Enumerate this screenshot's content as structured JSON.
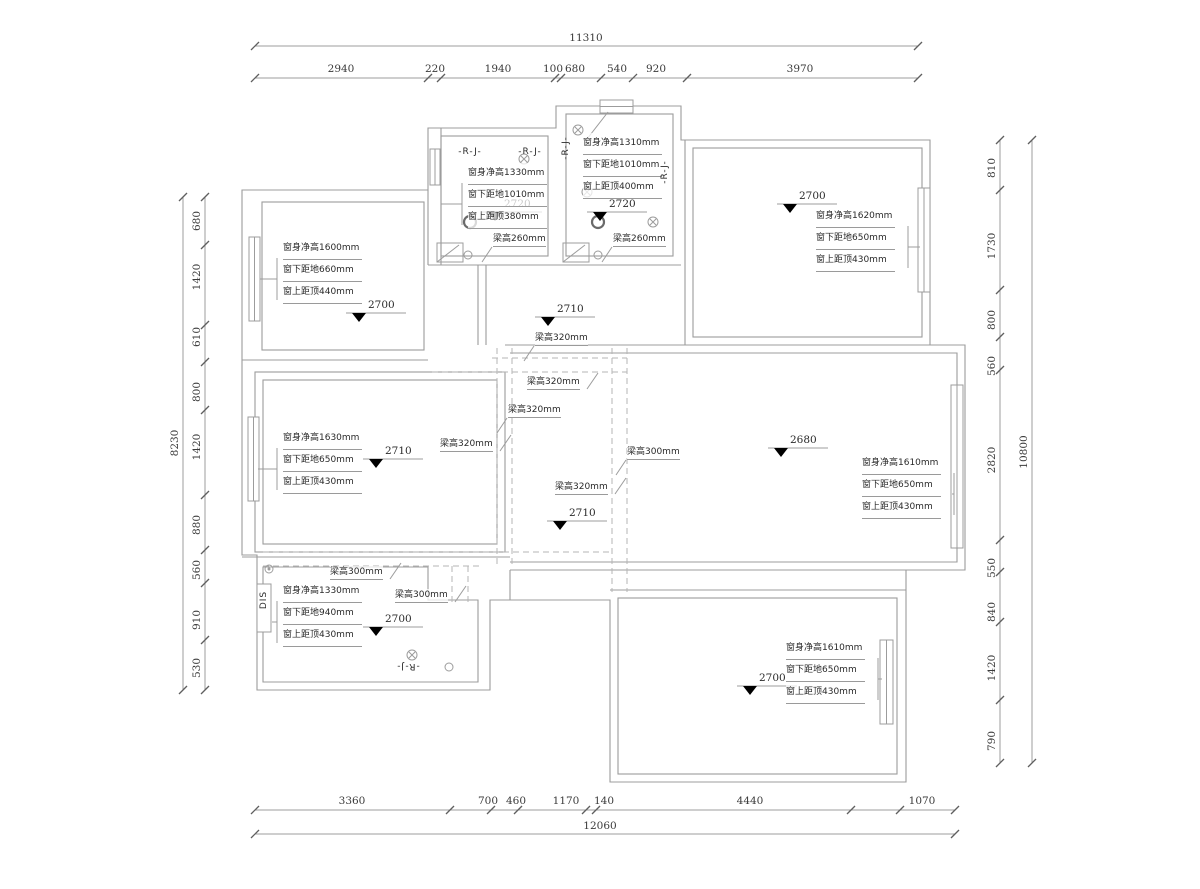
{
  "drawing": {
    "type": "floor-plan construction drawing"
  },
  "colors": {
    "wall_line": "#9c9c9c",
    "dash_line": "#b5b5b5",
    "tick": "#5f5f5f",
    "text": "#2a2a2a",
    "level_marker": "#000000"
  },
  "dim_top": {
    "total": {
      "label": "11310",
      "y": 46,
      "x1": 255,
      "x2": 918,
      "cx": 586
    },
    "seg": {
      "y": 78,
      "x1": 255,
      "x2": 918,
      "ticks": [
        255,
        428,
        441,
        555,
        561,
        601,
        633,
        687,
        918
      ],
      "labels": [
        {
          "t": "2940",
          "cx": 341
        },
        {
          "t": "220",
          "cx": 435
        },
        {
          "t": "1940",
          "cx": 498
        },
        {
          "t": "100",
          "cx": 553
        },
        {
          "t": "680",
          "cx": 575
        },
        {
          "t": "540",
          "cx": 617
        },
        {
          "t": "920",
          "cx": 656
        },
        {
          "t": "3970",
          "cx": 800
        }
      ]
    }
  },
  "dim_bottom": {
    "seg": {
      "y": 810,
      "x1": 255,
      "x2": 955,
      "ticks": [
        255,
        450,
        491,
        518,
        586,
        596,
        851,
        900,
        955
      ],
      "labels": [
        {
          "t": "3360",
          "cx": 352
        },
        {
          "t": "700",
          "cx": 488
        },
        {
          "t": "460",
          "cx": 516
        },
        {
          "t": "1170",
          "cx": 566
        },
        {
          "t": "140",
          "cx": 604
        },
        {
          "t": "4440",
          "cx": 750
        },
        {
          "t": "1070",
          "cx": 922
        }
      ]
    },
    "total": {
      "label": "12060",
      "y": 834,
      "x1": 255,
      "x2": 955,
      "cx": 600
    }
  },
  "dim_left": {
    "seg": {
      "x": 205,
      "y1": 197,
      "y2": 690,
      "ticks": [
        197,
        245,
        325,
        362,
        410,
        495,
        550,
        583,
        640,
        690
      ],
      "labels": [
        {
          "t": "680",
          "cy": 221
        },
        {
          "t": "1420",
          "cy": 277
        },
        {
          "t": "610",
          "cy": 337
        },
        {
          "t": "800",
          "cy": 392
        },
        {
          "t": "1420",
          "cy": 447
        },
        {
          "t": "880",
          "cy": 525
        },
        {
          "t": "560",
          "cy": 570
        },
        {
          "t": "910",
          "cy": 620
        },
        {
          "t": "530",
          "cy": 668
        }
      ]
    },
    "total": {
      "label": "8230",
      "x": 183,
      "y1": 197,
      "y2": 690,
      "cy": 443
    }
  },
  "dim_right": {
    "seg": {
      "x": 1000,
      "y1": 140,
      "y2": 763,
      "ticks": [
        140,
        190,
        290,
        337,
        370,
        540,
        572,
        622,
        700,
        763
      ],
      "labels": [
        {
          "t": "810",
          "cy": 168
        },
        {
          "t": "1730",
          "cy": 246
        },
        {
          "t": "800",
          "cy": 320
        },
        {
          "t": "560",
          "cy": 366
        },
        {
          "t": "2820",
          "cy": 460
        },
        {
          "t": "550",
          "cy": 568
        },
        {
          "t": "840",
          "cy": 612
        },
        {
          "t": "1420",
          "cy": 668
        },
        {
          "t": "790",
          "cy": 741
        }
      ]
    },
    "total": {
      "label": "10800",
      "x": 1032,
      "y1": 140,
      "y2": 763,
      "cy": 452
    }
  },
  "levels": [
    {
      "v": "2700",
      "x": 352,
      "y": 313
    },
    {
      "v": "2720",
      "x": 488,
      "y": 212
    },
    {
      "v": "2720",
      "x": 593,
      "y": 212
    },
    {
      "v": "2700",
      "x": 783,
      "y": 204
    },
    {
      "v": "2710",
      "x": 541,
      "y": 317
    },
    {
      "v": "2710",
      "x": 369,
      "y": 459
    },
    {
      "v": "2710",
      "x": 553,
      "y": 521
    },
    {
      "v": "2680",
      "x": 774,
      "y": 448
    },
    {
      "v": "2700",
      "x": 369,
      "y": 627
    },
    {
      "v": "2700",
      "x": 743,
      "y": 686
    }
  ],
  "window_blocks": [
    {
      "x": 283,
      "y": 238,
      "side": "left",
      "tx": 260,
      "lines": [
        "窗身净高1600mm",
        "窗下距地660mm",
        "窗上距顶440mm"
      ]
    },
    {
      "x": 468,
      "y": 163,
      "side": "left",
      "tx": 441,
      "lines": [
        "窗身净高1330mm",
        "窗下距地1010mm",
        "窗上距顶380mm"
      ]
    },
    {
      "x": 583,
      "y": 133,
      "side": "up",
      "tx": 608,
      "ty": 112,
      "lines": [
        "窗身净高1310mm",
        "窗下距地1010mm",
        "窗上距顶400mm"
      ]
    },
    {
      "x": 816,
      "y": 206,
      "side": "right",
      "tx": 920,
      "lines": [
        "窗身净高1620mm",
        "窗下距地650mm",
        "窗上距顶430mm"
      ]
    },
    {
      "x": 283,
      "y": 428,
      "side": "left",
      "tx": 258,
      "lines": [
        "窗身净高1630mm",
        "窗下距地650mm",
        "窗上距顶430mm"
      ]
    },
    {
      "x": 862,
      "y": 453,
      "side": "right",
      "tx": 952,
      "lines": [
        "窗身净高1610mm",
        "窗下距地650mm",
        "窗上距顶430mm"
      ]
    },
    {
      "x": 283,
      "y": 581,
      "side": "left",
      "tx": 272,
      "lines": [
        "窗身净高1330mm",
        "窗下距地940mm",
        "窗上距顶430mm"
      ]
    },
    {
      "x": 786,
      "y": 638,
      "side": "right",
      "tx": 882,
      "lines": [
        "窗身净高1610mm",
        "窗下距地650mm",
        "窗上距顶430mm"
      ]
    }
  ],
  "beam_labels": [
    {
      "t": "梁高260mm",
      "x": 493,
      "y": 233,
      "dir": "dl"
    },
    {
      "t": "梁高260mm",
      "x": 613,
      "y": 233,
      "dir": "dl"
    },
    {
      "t": "梁高320mm",
      "x": 535,
      "y": 332,
      "dir": "dl"
    },
    {
      "t": "梁高320mm",
      "x": 527,
      "y": 376,
      "dir": "ur"
    },
    {
      "t": "梁高320mm",
      "x": 508,
      "y": 404,
      "dir": "dl"
    },
    {
      "t": "梁高320mm",
      "x": 440,
      "y": 438,
      "dir": "ur"
    },
    {
      "t": "梁高300mm",
      "x": 627,
      "y": 446,
      "dir": "dl"
    },
    {
      "t": "梁高320mm",
      "x": 555,
      "y": 481,
      "dir": "ur"
    },
    {
      "t": "梁高300mm",
      "x": 330,
      "y": 566,
      "dir": "ur"
    },
    {
      "t": "梁高300mm",
      "x": 395,
      "y": 589,
      "dir": "ur"
    }
  ],
  "rj_labels": [
    {
      "t": "-R-J-",
      "x": 470,
      "y": 152,
      "rot": 0
    },
    {
      "t": "-R-J-",
      "x": 530,
      "y": 152,
      "rot": 0
    },
    {
      "t": "-R-J-",
      "x": 566,
      "y": 148,
      "rot": -90
    },
    {
      "t": "-R-J-",
      "x": 665,
      "y": 172,
      "rot": -90
    },
    {
      "t": "-R-J-",
      "x": 408,
      "y": 666,
      "rot": 180
    },
    {
      "t": "DIS",
      "x": 264,
      "y": 600,
      "rot": -90
    }
  ]
}
